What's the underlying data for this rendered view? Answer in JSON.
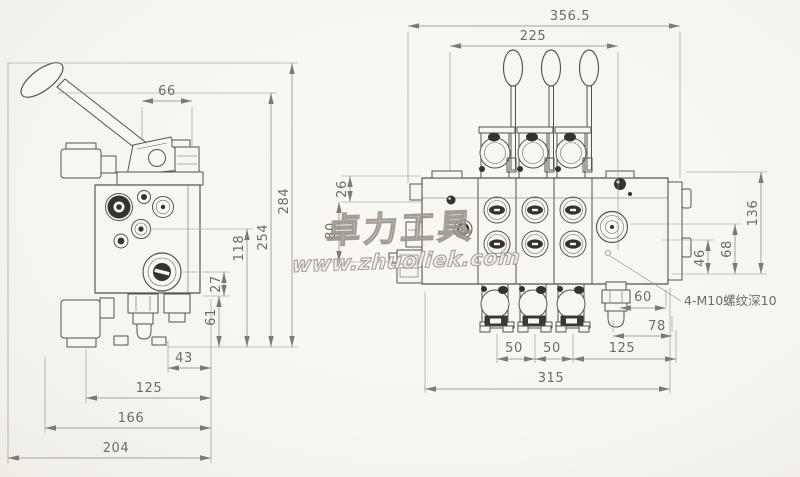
{
  "drawing": {
    "type": "engineering-dimension-drawing",
    "subject": "sectional multi-way hydraulic directional control valve, 3 spools",
    "colors": {
      "paper": "#f7f6f1",
      "ink": "#55534d",
      "dim_lines": "#8a877e",
      "watermark": "#9a948b"
    }
  },
  "side_view": {
    "dims": {
      "d66": "66",
      "d284": "284",
      "d254": "254",
      "d118": "118",
      "d27": "27",
      "d61": "61",
      "d43": "43",
      "d125": "125",
      "d166": "166",
      "d204": "204"
    }
  },
  "front_view": {
    "dims": {
      "d356_5": "356.5",
      "d225": "225",
      "d26": "26",
      "d80": "80",
      "d136": "136",
      "d68": "68",
      "d46": "46",
      "d60": "60",
      "d78": "78",
      "d125": "125",
      "d50a": "50",
      "d50b": "50",
      "d315": "315"
    },
    "annotation": {
      "thread_note": "4-M10螺纹深10"
    }
  },
  "watermark": {
    "brand": "卓力工具",
    "url": "www.zhuoliek.com"
  }
}
